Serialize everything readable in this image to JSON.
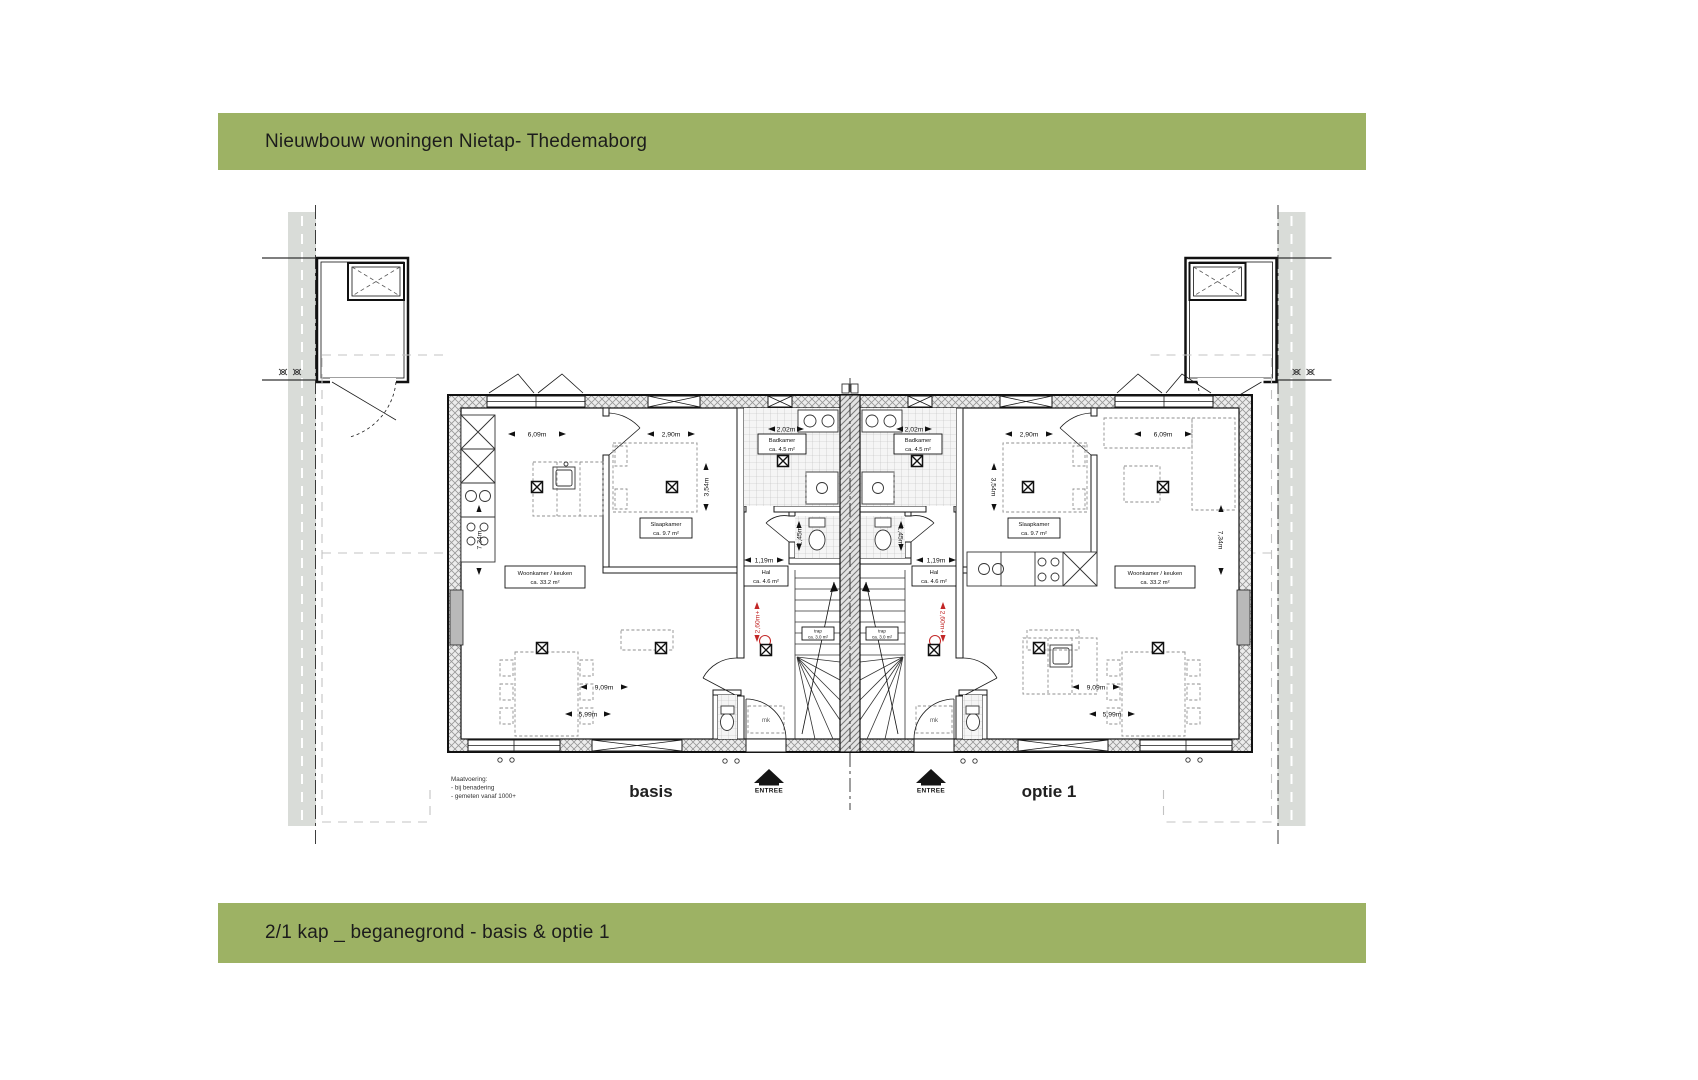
{
  "header": {
    "title": "Nieuwbouw woningen Nietap- Thedemaborg"
  },
  "footer": {
    "title": "2/1 kap _ beganegrond - basis & optie 1"
  },
  "colors": {
    "banner_green": "#9db264",
    "accent_red": "#c22626"
  },
  "plan": {
    "unit_left_label": "basis",
    "unit_right_label": "optie 1",
    "entree_label": "ENTREE",
    "mk_label": "mk",
    "level_marker": "2,60m+",
    "note": {
      "line1": "Maatvoering:",
      "line2": "- bij benadering",
      "line3": "- gemeten vanaf 1000+"
    },
    "rooms": {
      "living": {
        "name": "Woonkamer / keuken",
        "area": "ca.   33.2 m²"
      },
      "bedroom": {
        "name": "Slaapkamer",
        "area": "ca.   9.7 m²"
      },
      "bathroom": {
        "name": "Badkamer",
        "area": "ca.   4.5 m²"
      },
      "hall": {
        "name": "Hal",
        "area": "ca.  4.6 m²"
      },
      "stairs": {
        "name": "trap",
        "area": "ca. 3.0 m²"
      }
    },
    "dimensions": [
      {
        "label": "6,09m",
        "x": 537,
        "y": 434,
        "s": 58
      },
      {
        "label": "2,90m",
        "x": 671,
        "y": 434,
        "s": 48
      },
      {
        "label": "2,02m",
        "x": 786,
        "y": 429,
        "s": 36
      },
      {
        "label": "7,34m",
        "x": 479,
        "y": 540,
        "r": -90,
        "s": 70
      },
      {
        "label": "3,54m",
        "x": 706,
        "y": 487,
        "r": -90,
        "s": 48
      },
      {
        "label": "1,19m",
        "x": 764,
        "y": 560,
        "s": 40
      },
      {
        "label": "1,45m",
        "x": 799,
        "y": 536,
        "r": -90,
        "s": 30
      },
      {
        "label": "9,09m",
        "x": 604,
        "y": 687,
        "s": 48
      },
      {
        "label": "5,99m",
        "x": 588,
        "y": 714,
        "s": 46
      },
      {
        "label": "6,09m",
        "x": 1163,
        "y": 434,
        "s": 58
      },
      {
        "label": "2,90m",
        "x": 1029,
        "y": 434,
        "s": 48
      },
      {
        "label": "2,02m",
        "x": 914,
        "y": 429,
        "s": 36
      },
      {
        "label": "7,34m",
        "x": 1221,
        "y": 540,
        "r": 90,
        "s": 70
      },
      {
        "label": "3,54m",
        "x": 994,
        "y": 487,
        "r": 90,
        "s": 48
      },
      {
        "label": "1,19m",
        "x": 936,
        "y": 560,
        "s": 40
      },
      {
        "label": "1,45m",
        "x": 901,
        "y": 536,
        "r": 90,
        "s": 30
      },
      {
        "label": "9,09m",
        "x": 1096,
        "y": 687,
        "s": 48
      },
      {
        "label": "5,99m",
        "x": 1112,
        "y": 714,
        "s": 46
      },
      {
        "label": "2,60m+",
        "x": 757,
        "y": 622,
        "r": -90,
        "s": 40,
        "c": "red"
      },
      {
        "label": "2,60m+",
        "x": 943,
        "y": 622,
        "r": 90,
        "s": 40,
        "c": "red"
      }
    ],
    "light_points": [
      [
        537,
        487
      ],
      [
        672,
        487
      ],
      [
        766,
        650
      ],
      [
        542,
        648
      ],
      [
        661,
        648
      ],
      [
        783,
        461
      ],
      [
        1163,
        487
      ],
      [
        1028,
        487
      ],
      [
        934,
        650
      ],
      [
        1158,
        648
      ],
      [
        1039,
        648
      ],
      [
        917,
        461
      ]
    ],
    "entrances": [
      {
        "x": 769
      },
      {
        "x": 931
      }
    ]
  }
}
